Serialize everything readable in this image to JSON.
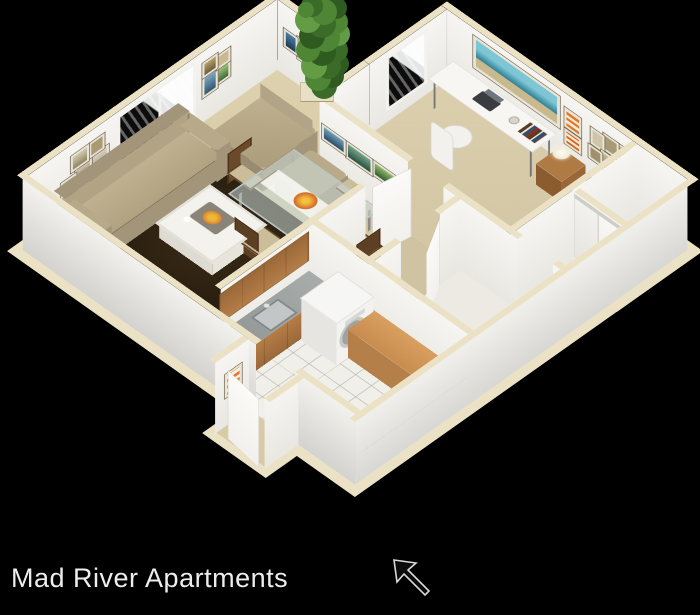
{
  "caption": {
    "title": "Mad River Apartments"
  },
  "icons": {
    "entrance_arrow": "arrow-pointing-to-entry-door",
    "tree": "decorative-tree"
  },
  "palette": {
    "background": "#000000",
    "exterior_wall": "#e9e8e4",
    "interior_wall": "#f4f3ef",
    "wall_top_trim": "#ebe2c6",
    "carpet": "#d7caa6",
    "area_rug": "#2e2213",
    "cabinet_wood": "#ad7742",
    "breakfast_bar_wood": "#cf9558",
    "bedding": "#57575b",
    "art_accent": "#e07a2a"
  },
  "scene": {
    "type": "3d-isometric-floor-plan",
    "unit": "one-bedroom one-bath apartment",
    "rooms": [
      "living room",
      "dining area",
      "bedroom",
      "bathroom",
      "kitchen",
      "closet",
      "hallway",
      "entry"
    ],
    "furnishings": [
      "sofa with pillows",
      "armchair and ottoman",
      "coffee table with tray",
      "area rug",
      "floor lamp",
      "glass dining table with four chairs",
      "desk with laptop and office chair",
      "bed with nightstand and lamp",
      "washer-dryer",
      "kitchen sink and cabinets",
      "breakfast bar",
      "sliding-door closet",
      "framed wall art",
      "windows",
      "patio door"
    ]
  }
}
